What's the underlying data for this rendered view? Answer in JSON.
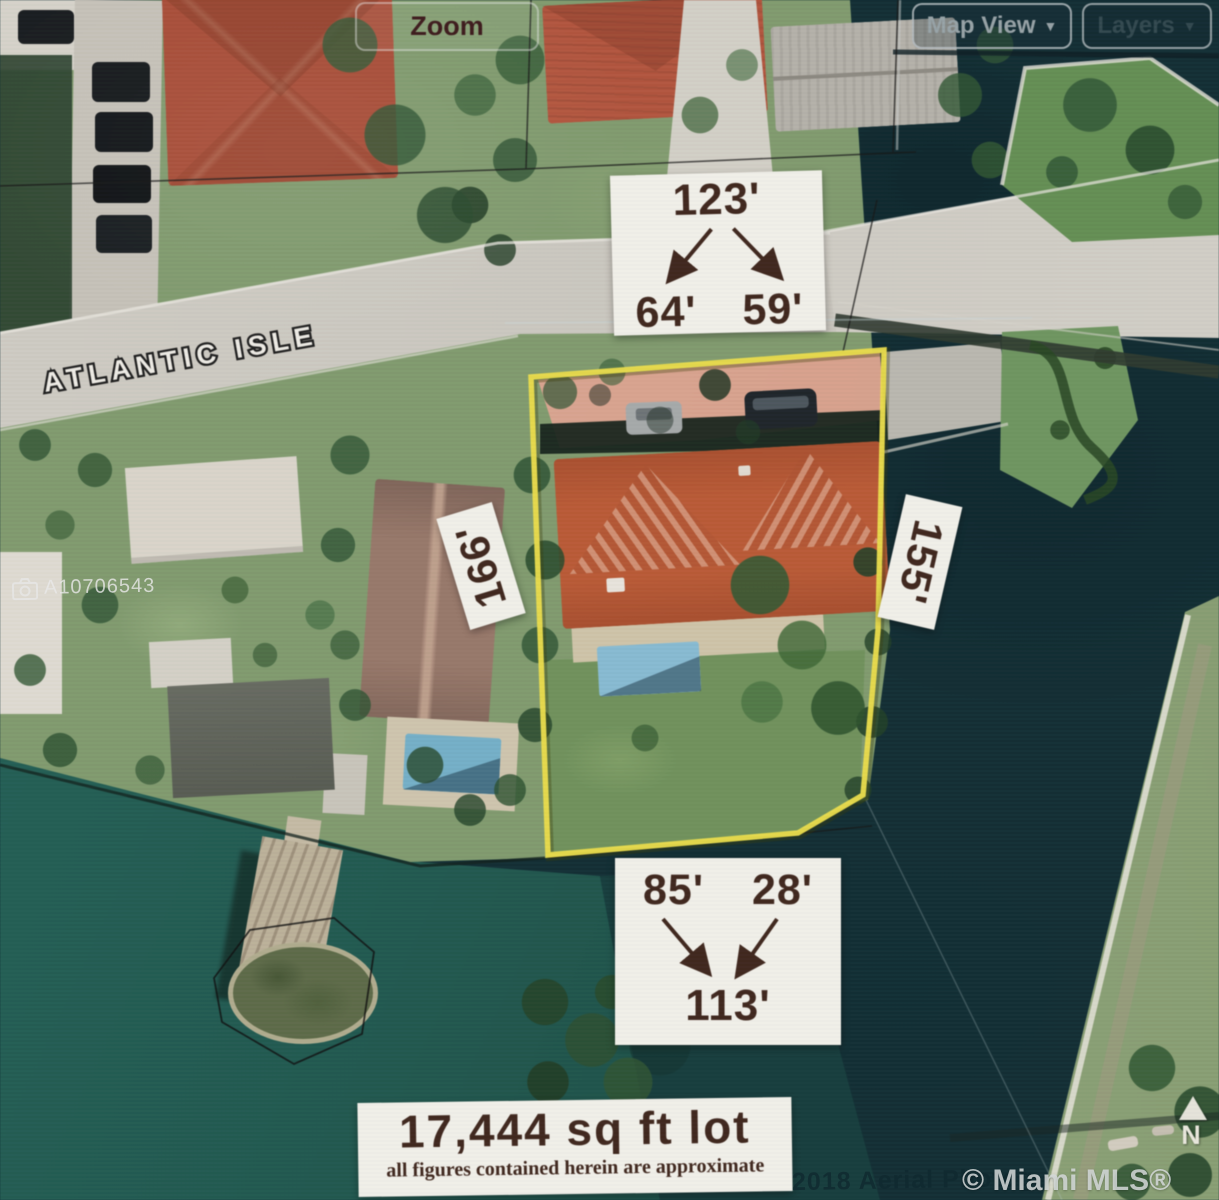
{
  "toolbar": {
    "zoom_label": "Zoom",
    "map_view_label": "Map View",
    "layers_label": "Layers",
    "dropdown_glyph": "▼"
  },
  "map": {
    "street_label": "ATLANTIC ISLE",
    "compass_label": "N"
  },
  "annotations": {
    "front": {
      "total": "123'",
      "left_segment": "64'",
      "right_segment": "59'"
    },
    "west_side": "166'",
    "east_side": "155'",
    "rear": {
      "left_segment": "85'",
      "right_segment": "28'",
      "total": "113'"
    },
    "lot_area": "17,444 sq ft lot",
    "disclaimer": "all figures contained herein are approximate"
  },
  "watermarks": {
    "listing_id": "A10706543",
    "mls_credit": "© Miami MLS® 07/2019",
    "aerial_credit": "2018 Aerial Photog"
  },
  "colors": {
    "lot_outline": "#f2e33c",
    "water_dark": "#0d2d34",
    "water_teal": "#1a5a50",
    "label_background": "#f5f3ec",
    "label_text": "#40251a",
    "roof_orange": "#c4582f"
  }
}
